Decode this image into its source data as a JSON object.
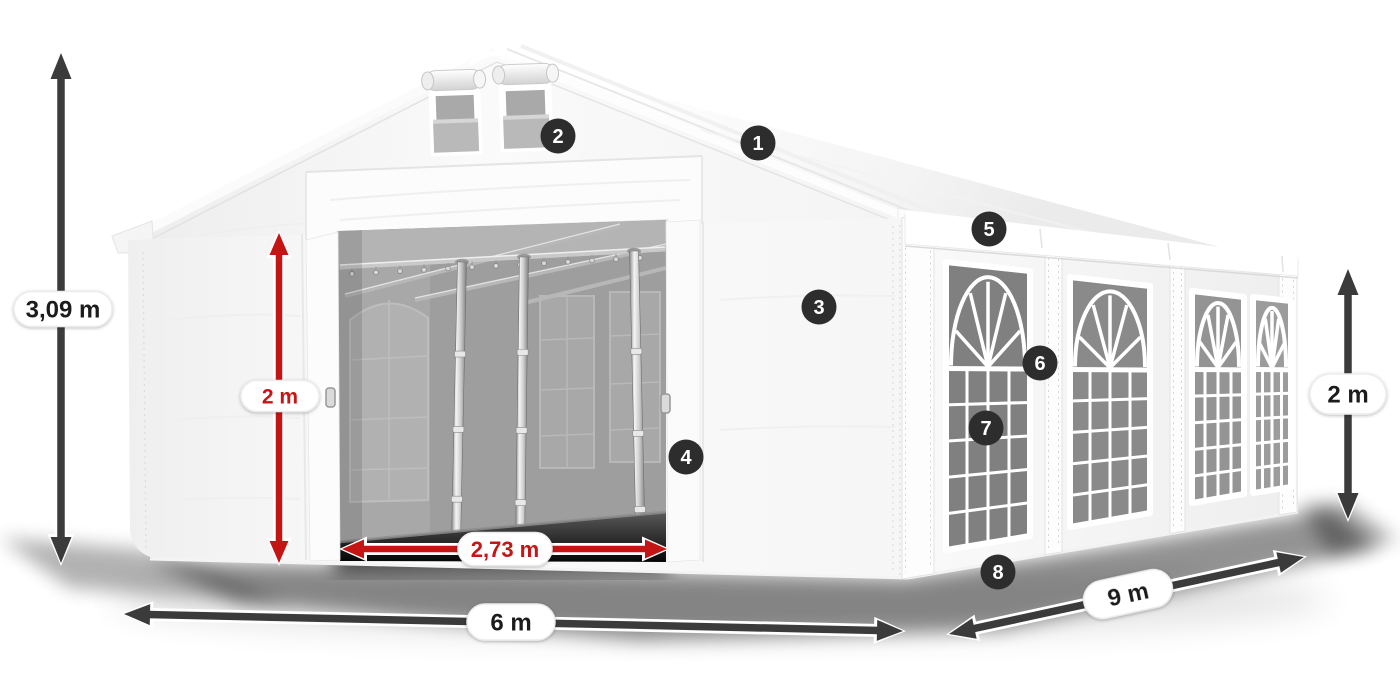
{
  "page": {
    "background_color": "#ffffff"
  },
  "diagram": {
    "description": "Party tent dimension diagram with numbered feature callouts",
    "callouts": [
      {
        "number": "1"
      },
      {
        "number": "2"
      },
      {
        "number": "3"
      },
      {
        "number": "4"
      },
      {
        "number": "5"
      },
      {
        "number": "6"
      },
      {
        "number": "7"
      },
      {
        "number": "8"
      }
    ],
    "dimensions": {
      "total_height": "3,09 m",
      "door_height": "2 m",
      "door_width": "2,73 m",
      "front_width": "6 m",
      "side_length": "9 m",
      "side_height": "2 m"
    },
    "colors": {
      "accent_red": "#c41414",
      "arrow_dark": "#3b3b3b",
      "badge_background": "#2d2d2d",
      "badge_number": "#ffffff",
      "label_text": "#1c1c1c"
    }
  }
}
